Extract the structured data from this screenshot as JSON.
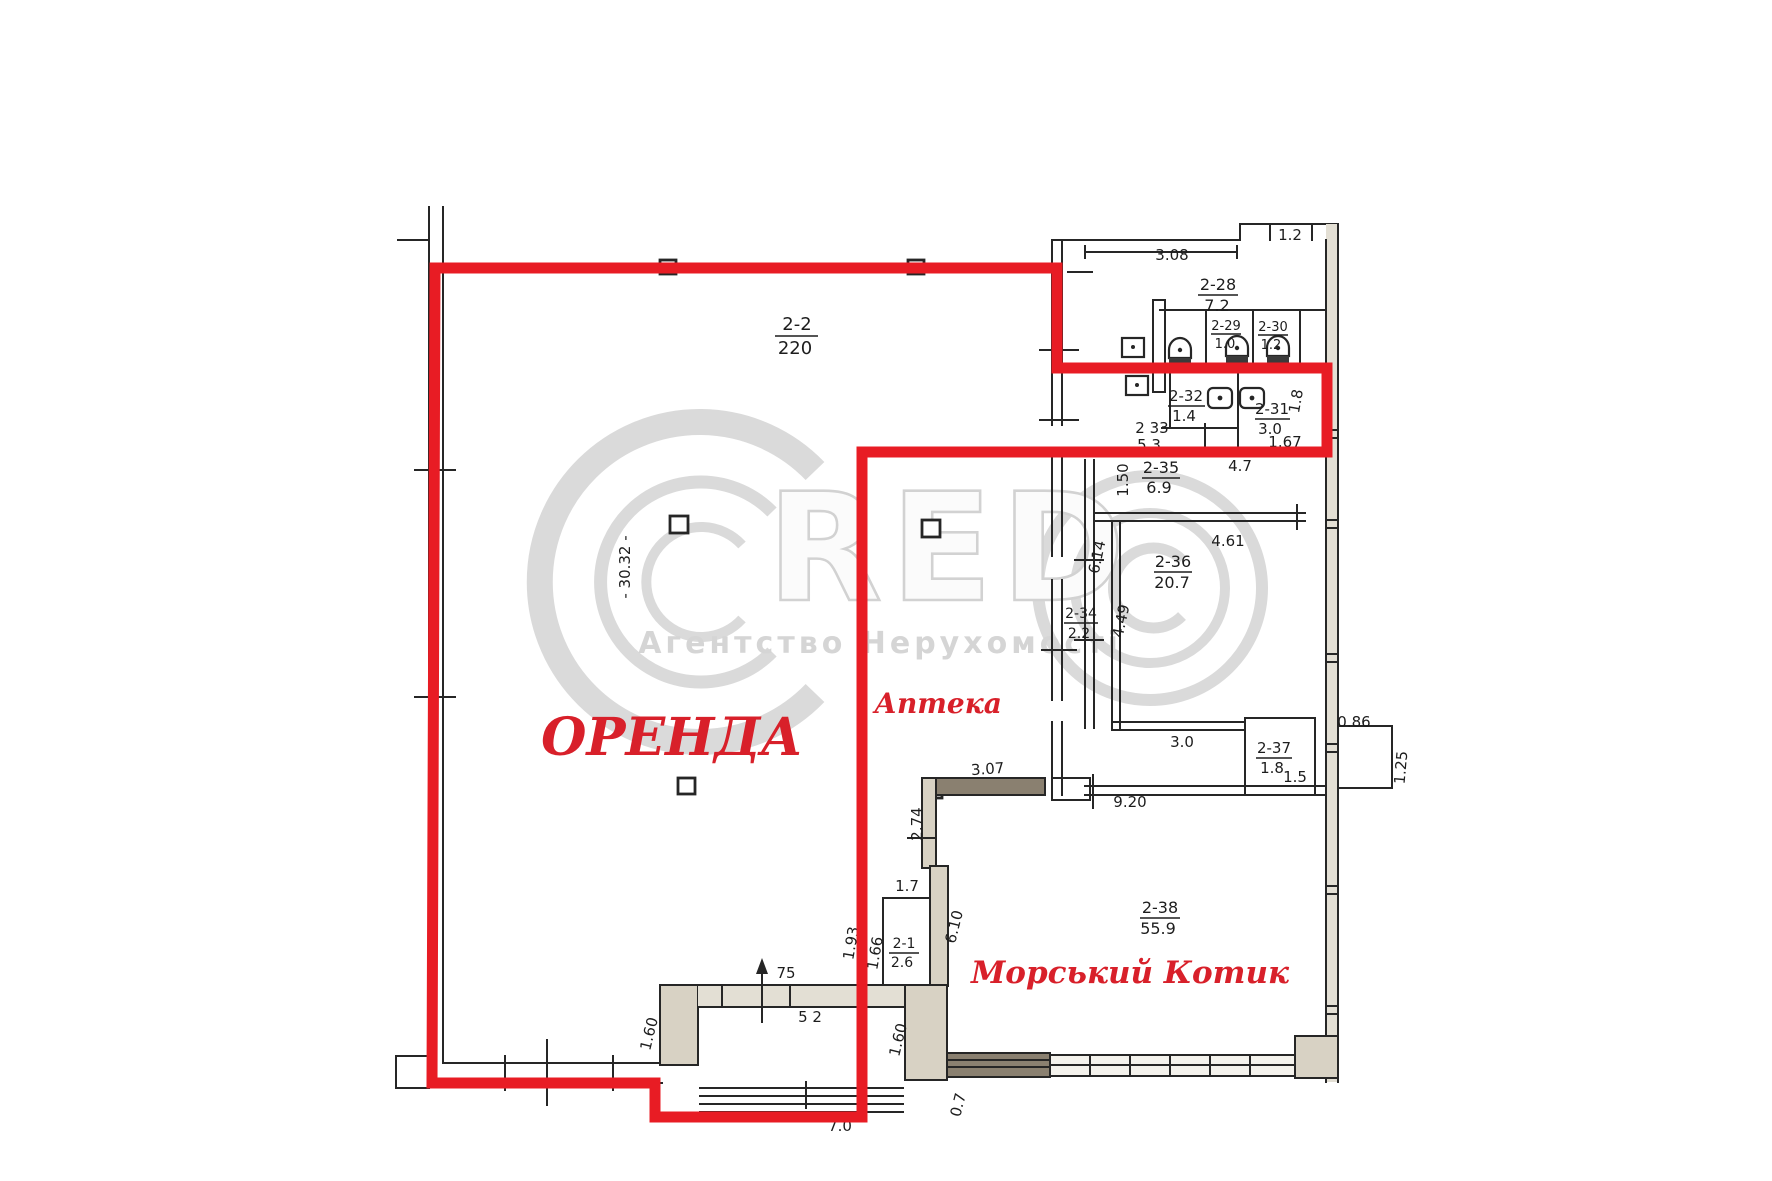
{
  "colors": {
    "accent_red": "#e81c24",
    "wall": "#262626",
    "watermark_grey": "#d5d5d5"
  },
  "watermark": {
    "letters": "RED",
    "subtitle": "Агентство Нерухомості"
  },
  "overlay": {
    "rent_label": "ОРЕНДА",
    "pharmacy_label": "Аптека",
    "tenant_label": "Морський Котик"
  },
  "rooms": {
    "r2_2": {
      "id": "2-2",
      "area": "220"
    },
    "r2_28": {
      "id": "2-28",
      "area": "7.2"
    },
    "r2_29": {
      "id": "2-29",
      "area": "1.0"
    },
    "r2_30": {
      "id": "2-30",
      "area": "1.2"
    },
    "r2_31": {
      "id": "2-31",
      "area": "3.0"
    },
    "r2_32": {
      "id": "2-32",
      "area": "1.4"
    },
    "r2_33": {
      "id": "2 33",
      "area": "5.3"
    },
    "r2_34": {
      "id": "2-34",
      "area": "2.2"
    },
    "r2_35": {
      "id": "2-35",
      "area": "6.9"
    },
    "r2_36": {
      "id": "2-36",
      "area": "20.7"
    },
    "r2_37": {
      "id": "2-37",
      "area": "1.8"
    },
    "r2_38": {
      "id": "2-38",
      "area": "55.9"
    },
    "r2_1": {
      "id": "2-1",
      "area": "2.6"
    }
  },
  "dims": {
    "d308": "3.08",
    "d12": "1.2",
    "d3032": "- 30.32 -",
    "d150": "1.50",
    "d47": "4.7",
    "d461": "4.61",
    "d614": "6.14",
    "d449": "4.49",
    "d167": "1.67",
    "d18": "1.8",
    "d30": "3.0",
    "d086": "0.86",
    "d125": "1.25",
    "d15": "1.5",
    "d920": "9.20",
    "d307": "3.07",
    "d274": "2.74",
    "d17": "1.7",
    "d193": "1.93",
    "d166": "1.66",
    "d610": "6.10",
    "d75": "75",
    "d52": "5 2",
    "d160a": "1.60",
    "d160b": "1.60",
    "d07": "0.7",
    "d70": "7.0"
  }
}
